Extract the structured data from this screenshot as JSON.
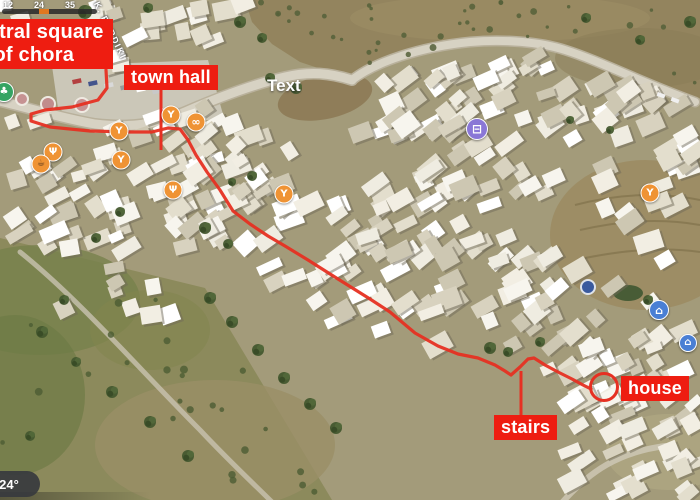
{
  "theme": {
    "label_bg": "#ee1d11",
    "route_color": "#e63022",
    "poi_food_color": "#ef9334",
    "poi_transit_color": "#8a77d6",
    "poi_museum_color": "#4a7fd4",
    "poi_park_color": "#35a463"
  },
  "map": {
    "street_name": "K. PERDIKI",
    "watermark_text": "Text",
    "weather_chip": "24°",
    "hud": {
      "numbers": [
        "12",
        "24",
        "35"
      ]
    }
  },
  "annotations": {
    "labels": {
      "central_square": {
        "line1": "central square",
        "line2": "of chora"
      },
      "town_hall": "town hall",
      "stairs": "stairs",
      "house": "house"
    },
    "route_points": [
      [
        106,
        70
      ],
      [
        107,
        88
      ],
      [
        98,
        100
      ],
      [
        72,
        107
      ],
      [
        45,
        110
      ],
      [
        31,
        114
      ],
      [
        31,
        121
      ],
      [
        50,
        127
      ],
      [
        90,
        131
      ],
      [
        130,
        132
      ],
      [
        152,
        132
      ],
      [
        168,
        128
      ],
      [
        180,
        129
      ],
      [
        188,
        140
      ],
      [
        196,
        155
      ],
      [
        207,
        172
      ],
      [
        220,
        190
      ],
      [
        233,
        211
      ],
      [
        250,
        224
      ],
      [
        268,
        236
      ],
      [
        285,
        246
      ],
      [
        308,
        260
      ],
      [
        338,
        279
      ],
      [
        370,
        299
      ],
      [
        390,
        312
      ],
      [
        415,
        333
      ],
      [
        438,
        346
      ],
      [
        458,
        354
      ],
      [
        478,
        358
      ],
      [
        495,
        365
      ],
      [
        505,
        371
      ],
      [
        511,
        375
      ],
      [
        520,
        367
      ],
      [
        528,
        359
      ],
      [
        534,
        358
      ],
      [
        545,
        365
      ],
      [
        558,
        372
      ],
      [
        572,
        379
      ],
      [
        583,
        385
      ],
      [
        591,
        389
      ]
    ],
    "house_circle": {
      "cx": 604,
      "cy": 387,
      "r": 13.5
    },
    "leader_lines": [
      {
        "name": "town-hall-leader-line",
        "x": 161,
        "y1": 89,
        "y2": 150
      },
      {
        "name": "stairs-leader-line",
        "x": 521,
        "y1": 371,
        "y2": 415
      }
    ]
  },
  "pois": [
    {
      "name": "park",
      "glyph": "♣",
      "bg": "#35a463",
      "x": 4,
      "y": 92,
      "d": 18,
      "fs": 10
    },
    {
      "name": "restaurant",
      "glyph": "Ψ",
      "bg": "#ef9334",
      "x": 53,
      "y": 152,
      "d": 17,
      "fs": 10
    },
    {
      "name": "cafe",
      "glyph": "☕",
      "bg": "#ef9334",
      "x": 41,
      "y": 164,
      "d": 17,
      "fs": 9,
      "dark": true
    },
    {
      "name": "bar",
      "glyph": "Y",
      "bg": "#ef9334",
      "x": 119,
      "y": 131,
      "d": 17,
      "fs": 10
    },
    {
      "name": "bar",
      "glyph": "Y",
      "bg": "#ef9334",
      "x": 171,
      "y": 115,
      "d": 17,
      "fs": 10
    },
    {
      "name": "donut-shop",
      "glyph": "∞",
      "bg": "#ef9334",
      "x": 196,
      "y": 122,
      "d": 17,
      "fs": 11
    },
    {
      "name": "bar",
      "glyph": "Y",
      "bg": "#ef9334",
      "x": 121,
      "y": 160,
      "d": 17,
      "fs": 10
    },
    {
      "name": "restaurant",
      "glyph": "Ψ",
      "bg": "#ef9334",
      "x": 173,
      "y": 190,
      "d": 17,
      "fs": 10
    },
    {
      "name": "bar",
      "glyph": "Y",
      "bg": "#ef9334",
      "x": 284,
      "y": 194,
      "d": 17,
      "fs": 10
    },
    {
      "name": "bus-station",
      "glyph": "⊟",
      "bg": "#8a77d6",
      "x": 477,
      "y": 129,
      "d": 20,
      "fs": 12
    },
    {
      "name": "bar",
      "glyph": "Y",
      "bg": "#ef9334",
      "x": 650,
      "y": 193,
      "d": 17,
      "fs": 10
    },
    {
      "name": "museum",
      "glyph": "⌂",
      "bg": "#4a7fd4",
      "x": 659,
      "y": 310,
      "d": 18,
      "fs": 11
    },
    {
      "name": "museum",
      "glyph": "⌂",
      "bg": "#4a7fd4",
      "x": 688,
      "y": 343,
      "d": 16,
      "fs": 10
    }
  ]
}
